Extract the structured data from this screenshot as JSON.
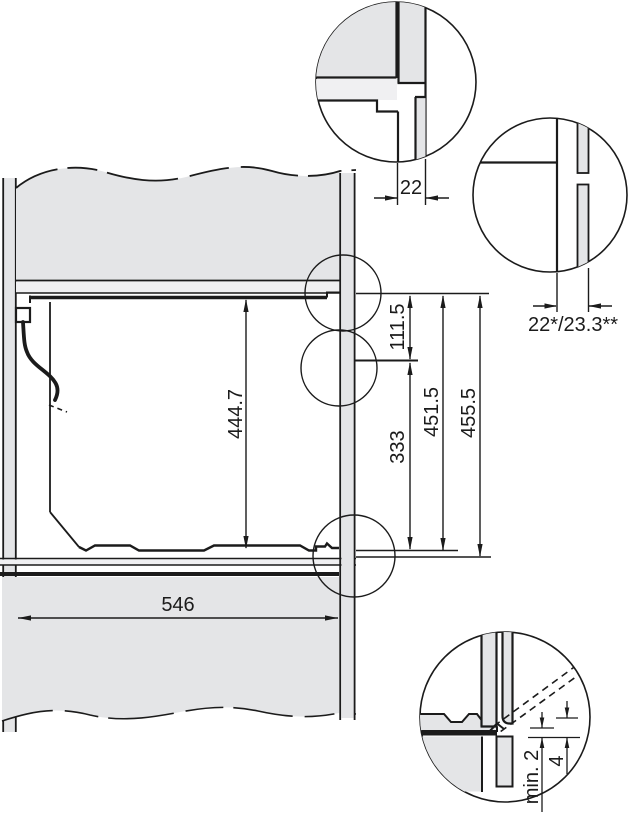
{
  "drawing": {
    "colors": {
      "panel_gray": "#e4e5e7",
      "light_gray": "#f0f0f2",
      "line": "#1b1b1b",
      "background": "#ffffff"
    },
    "dimensions": {
      "niche_inner_height": "444.7",
      "top_section_height": "111.5",
      "bottom_section_height": "333",
      "opening_height_a": "451.5",
      "opening_height_b": "455.5",
      "niche_width": "546",
      "front_panel_depth": "22",
      "front_panel_depth_variants": "22*/23.3**",
      "min_clearance": "min. 2",
      "base_offset": "4"
    }
  }
}
